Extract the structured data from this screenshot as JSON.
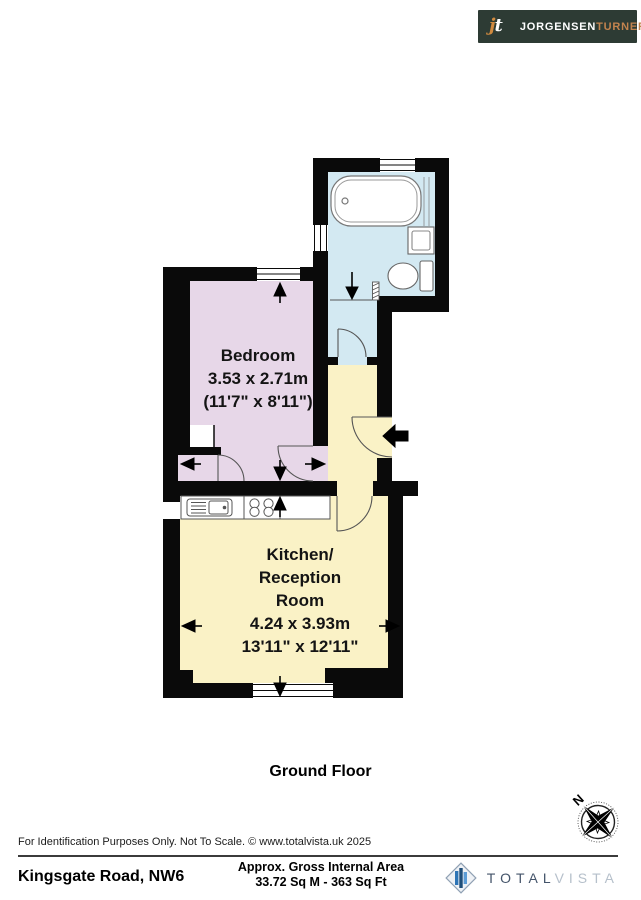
{
  "agency_logo": {
    "initial_first": "j",
    "initial_second": "t",
    "name_primary": "JORGENSEN",
    "name_secondary": "TURNER"
  },
  "floor_plan": {
    "floor_label": "Ground Floor",
    "compass_label": "N",
    "rooms": {
      "bedroom": {
        "name": "Bedroom",
        "dims_metric": "3.53 x 2.71m",
        "dims_imperial": "(11'7\" x 8'11\")"
      },
      "kitchen": {
        "name_line1": "Kitchen/",
        "name_line2": "Reception",
        "name_line3": "Room",
        "dims_metric": "4.24 x 3.93m",
        "dims_imperial": "13'11\" x 12'11\""
      }
    }
  },
  "footer": {
    "disclaimer": "For Identification Purposes Only. Not To Scale. © www.totalvista.uk  2025",
    "address": "Kingsgate Road, NW6",
    "area_label": "Approx. Gross Internal Area",
    "area_value": "33.72 Sq M - 363 Sq Ft"
  },
  "provider_logo": {
    "part1": "TOTAL",
    "part2": "VISTA"
  },
  "colors": {
    "wall": "#0a0a0a",
    "bedroom": "#e7d7e8",
    "bathroom": "#d3e9f2",
    "kitchen": "#faf2c6",
    "agency_bg": "#2d3b34",
    "agency_accent": "#c2834e",
    "brand_dark": "#44546a",
    "brand_light": "#b6c0cb",
    "brand_blue": "#2e75b6",
    "brand_blue_dark": "#1f4e79",
    "brand_blue_light": "#5b9bd5"
  }
}
